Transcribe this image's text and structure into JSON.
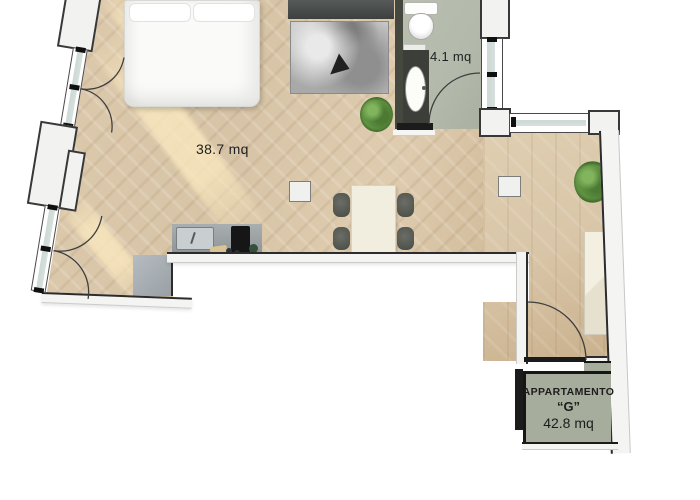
{
  "plan": {
    "main_room": {
      "area_label": "38.7 mq"
    },
    "bathroom": {
      "area_label": "4.1 mq"
    },
    "apartment_badge": {
      "line1": "APPARTAMENTO",
      "line2": "“G”",
      "line3": "42.8 mq"
    },
    "colors": {
      "floor_wood": "#d7c4a6",
      "floor_wood2": "#d9c6a8",
      "bath_floor": "#b4baab",
      "badge_bg": "#a7ad9c",
      "wall_dark": "#2c2c2c",
      "balcony": "#a9b0b5",
      "glass": "#d6e0dd",
      "plant": "#5e9140",
      "ink": "#1c1c1c"
    },
    "elements": [
      "bed",
      "pillows",
      "tv-console",
      "rug",
      "dining-table",
      "chairs",
      "kitchen-counter",
      "kitchen-sink",
      "cooktop",
      "wardrobe",
      "toilet",
      "washbasin",
      "vanity",
      "plants",
      "balcony",
      "windows",
      "door-swings",
      "columns"
    ]
  }
}
